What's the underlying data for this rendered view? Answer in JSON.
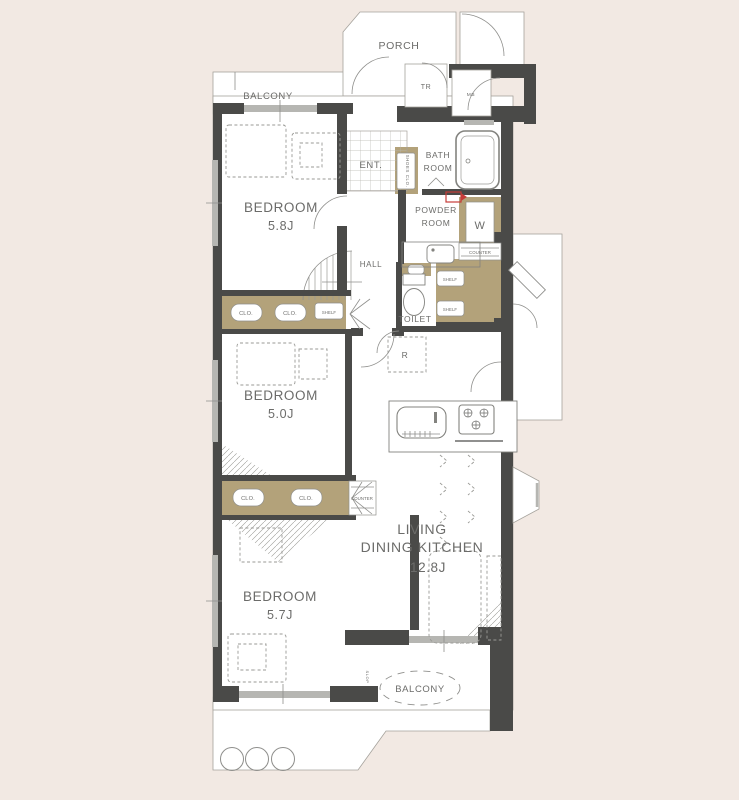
{
  "plan_type": "apartment-floor-plan",
  "colors": {
    "background": "#f2e9e3",
    "wall": "#4a4a48",
    "storage_tan": "#b3a27a",
    "line_gray": "#8f8f8c",
    "window_gray": "#b6b6b2",
    "accent_red": "#c63c39",
    "text": "#6c6c6a"
  },
  "labels": {
    "porch": "PORCH",
    "balcony_top": "BALCONY",
    "balcony_bottom": "BALCONY",
    "tr": "TR",
    "mb": "MB",
    "ent": "ENT.",
    "shoes_clo": "SHOES CLO.",
    "bath_line1": "BATH",
    "bath_line2": "ROOM",
    "powder_line1": "POWDER",
    "powder_line2": "ROOM",
    "washer": "W",
    "counter_powder": "COUNTER",
    "shelf_1": "SHELF",
    "shelf_2": "SHELF",
    "toilet": "TOILET",
    "hall": "HALL",
    "fridge": "R",
    "clo_a1": "CLO.",
    "clo_a2": "CLO.",
    "shelf_a": "SHELF",
    "clo_b1": "CLO.",
    "clo_b2": "CLO.",
    "counter_b": "COUNTER",
    "slop": "SLOP",
    "bedroom1_name": "BEDROOM",
    "bedroom1_size": "5.8J",
    "bedroom2_name": "BEDROOM",
    "bedroom2_size": "5.0J",
    "bedroom3_name": "BEDROOM",
    "bedroom3_size": "5.7J",
    "ldk_line1": "LIVING",
    "ldk_line2": "DINING KITCHEN",
    "ldk_size": "12.8J"
  }
}
